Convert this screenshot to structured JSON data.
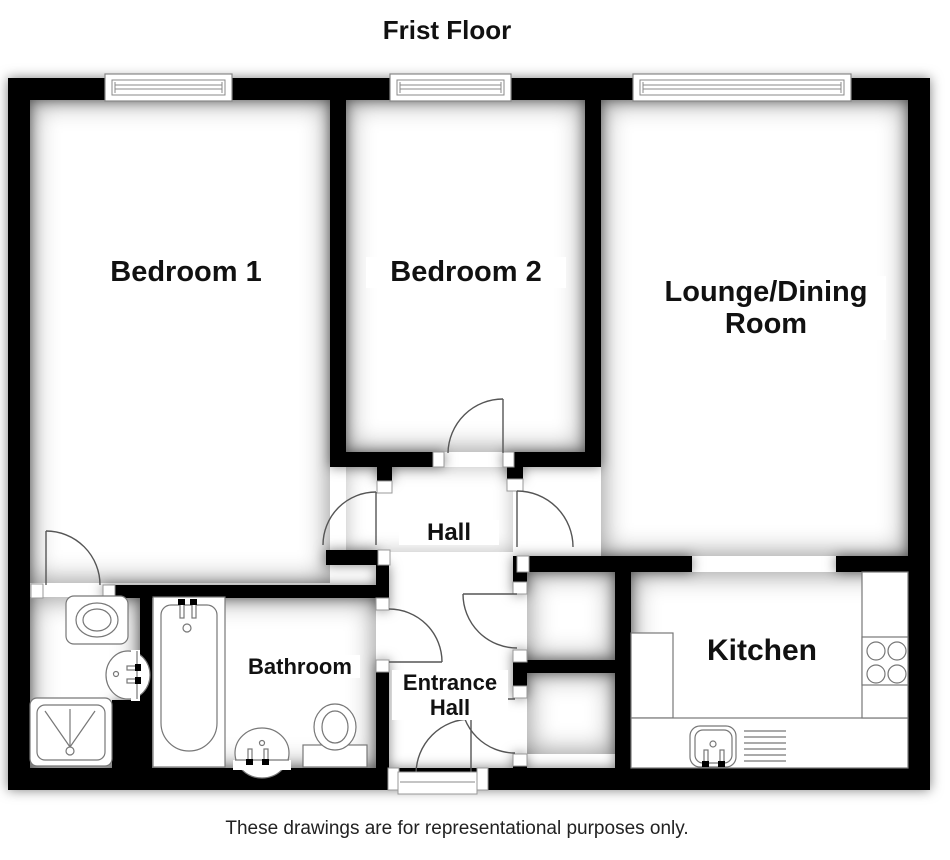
{
  "title": "Frist Floor",
  "rooms": {
    "bedroom1": "Bedroom 1",
    "bedroom2": "Bedroom 2",
    "lounge": "Lounge/Dining Room",
    "hall": "Hall",
    "bathroom": "Bathroom",
    "entrance_hall": "Entrance Hall",
    "kitchen": "Kitchen"
  },
  "disclaimer": "These drawings are for representational purposes only.",
  "colors": {
    "wall": "#000000",
    "door_line": "#555555",
    "fixture_line": "#777777",
    "background": "#ffffff"
  },
  "fixtures": [
    "window",
    "door",
    "bath",
    "toilet",
    "wash-basin",
    "shower-tray",
    "kitchen-sink",
    "hob",
    "counter",
    "front-door-step"
  ]
}
